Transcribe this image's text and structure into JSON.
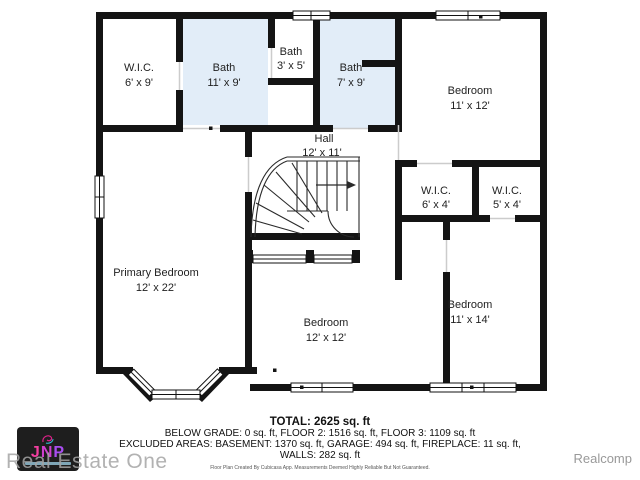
{
  "plan": {
    "rooms": [
      {
        "name": "W.I.C.",
        "dims": "6' x 9'"
      },
      {
        "name": "Bath",
        "dims": "11' x 9'"
      },
      {
        "name": "Bath",
        "dims": "3' x 5'"
      },
      {
        "name": "Bath",
        "dims": "7' x 9'"
      },
      {
        "name": "Bedroom",
        "dims": "11' x 12'"
      },
      {
        "name": "Hall",
        "dims": "12' x 11'"
      },
      {
        "name": "W.I.C.",
        "dims": "6' x 4'"
      },
      {
        "name": "W.I.C.",
        "dims": "5' x 4'"
      },
      {
        "name": "Primary Bedroom",
        "dims": "12' x 22'"
      },
      {
        "name": "Bedroom",
        "dims": "12' x 12'"
      },
      {
        "name": "Bedroom",
        "dims": "11' x 14'"
      }
    ],
    "colors": {
      "wall": "#141414",
      "bath_fill": "#e2edf8",
      "room_fill": "#ffffff",
      "threshold": "#cccccc"
    }
  },
  "summary": {
    "total": "TOTAL: 2625 sq. ft",
    "line2": "BELOW GRADE: 0 sq. ft, FLOOR 2: 1516 sq. ft, FLOOR 3: 1109 sq. ft",
    "line3": "EXCLUDED AREAS: BASEMENT: 1370 sq. ft, GARAGE: 494 sq. ft, FIREPLACE: 11 sq. ft,",
    "line4": "WALLS: 282 sq. ft",
    "disclaimer": "Floor Plan Created By Cubicasa App. Measurements Deemed Highly Reliable But Not Guaranteed."
  },
  "branding": {
    "logo_letters": {
      "0": "J",
      "1": "N",
      "2": "P"
    },
    "watermark": "Real Estate One",
    "attribution": "Realcomp"
  }
}
